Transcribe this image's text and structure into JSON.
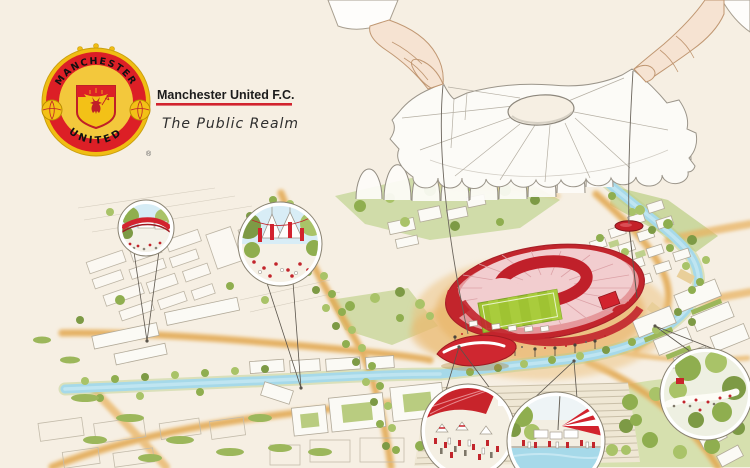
{
  "header": {
    "club_name": "Manchester United F.C.",
    "subtitle": "The Public Realm",
    "crest": {
      "top_banner": "MANCHESTER",
      "bottom_banner": "UNITED",
      "registered_mark": "®"
    }
  },
  "colors": {
    "background": "#f6efe3",
    "club_red": "#d2232e",
    "crest_gold": "#f3c117",
    "roof_pink": "#f2cdcf",
    "pitch_green": "#9fc332",
    "water_blue": "#a6d9e9",
    "road_orange": "#e8b362",
    "tree_green": "#8fae4f",
    "skin_tone": "#f6e3d2"
  },
  "illustration": {
    "callouts": [
      {
        "name": "bridge-over-canal-detail"
      },
      {
        "name": "gateway-plaza-detail"
      },
      {
        "name": "stadium-concourse-market-detail"
      },
      {
        "name": "waterside-promenade-detail"
      },
      {
        "name": "riverside-park-detail"
      }
    ]
  }
}
